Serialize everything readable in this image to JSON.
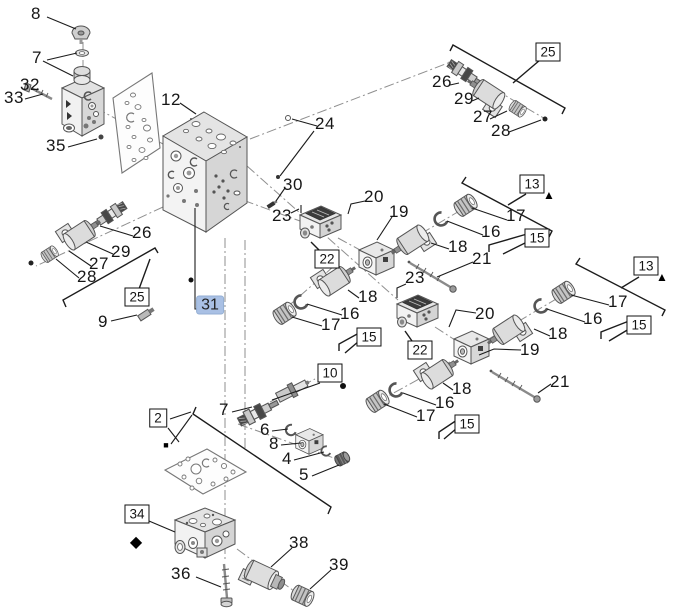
{
  "diagram": {
    "type": "exploded-parts-diagram",
    "background_color": "#ffffff",
    "line_color": "#1c1c1c",
    "highlighted_item": "31",
    "highlight_bg_color": "#a9c0e4",
    "callouts": [
      {
        "text": "8",
        "kind": "plain",
        "x": 36,
        "y": 14
      },
      {
        "text": "7",
        "kind": "plain",
        "x": 37,
        "y": 58
      },
      {
        "text": "32",
        "kind": "plain",
        "x": 30,
        "y": 85
      },
      {
        "text": "33",
        "kind": "plain",
        "x": 14,
        "y": 98
      },
      {
        "text": "35",
        "kind": "plain",
        "x": 56,
        "y": 146
      },
      {
        "text": "12",
        "kind": "plain",
        "x": 171,
        "y": 100
      },
      {
        "text": "24",
        "kind": "plain",
        "x": 325,
        "y": 124
      },
      {
        "text": "30",
        "kind": "plain",
        "x": 293,
        "y": 185
      },
      {
        "text": "23",
        "kind": "plain",
        "x": 282,
        "y": 216
      },
      {
        "text": "26",
        "kind": "plain",
        "x": 142,
        "y": 233
      },
      {
        "text": "29",
        "kind": "plain",
        "x": 121,
        "y": 252
      },
      {
        "text": "27",
        "kind": "plain",
        "x": 99,
        "y": 264
      },
      {
        "text": "28",
        "kind": "plain",
        "x": 87,
        "y": 277
      },
      {
        "text": "9",
        "kind": "plain",
        "x": 103,
        "y": 322
      },
      {
        "text": "26",
        "kind": "plain",
        "x": 442,
        "y": 82
      },
      {
        "text": "29",
        "kind": "plain",
        "x": 464,
        "y": 99
      },
      {
        "text": "27",
        "kind": "plain",
        "x": 483,
        "y": 117
      },
      {
        "text": "28",
        "kind": "plain",
        "x": 501,
        "y": 131
      },
      {
        "text": "20",
        "kind": "plain",
        "x": 374,
        "y": 197
      },
      {
        "text": "19",
        "kind": "plain",
        "x": 399,
        "y": 212
      },
      {
        "text": "18",
        "kind": "plain",
        "x": 368,
        "y": 297
      },
      {
        "text": "16",
        "kind": "plain",
        "x": 350,
        "y": 314
      },
      {
        "text": "17",
        "kind": "plain",
        "x": 331,
        "y": 325
      },
      {
        "text": "18",
        "kind": "plain",
        "x": 458,
        "y": 247
      },
      {
        "text": "21",
        "kind": "plain",
        "x": 482,
        "y": 259
      },
      {
        "text": "23",
        "kind": "plain",
        "x": 415,
        "y": 278
      },
      {
        "text": "17",
        "kind": "plain",
        "x": 516,
        "y": 216
      },
      {
        "text": "16",
        "kind": "plain",
        "x": 491,
        "y": 232
      },
      {
        "text": "20",
        "kind": "plain",
        "x": 485,
        "y": 314
      },
      {
        "text": "19",
        "kind": "plain",
        "x": 530,
        "y": 350
      },
      {
        "text": "18",
        "kind": "plain",
        "x": 558,
        "y": 334
      },
      {
        "text": "21",
        "kind": "plain",
        "x": 560,
        "y": 382
      },
      {
        "text": "17",
        "kind": "plain",
        "x": 618,
        "y": 302
      },
      {
        "text": "16",
        "kind": "plain",
        "x": 593,
        "y": 319
      },
      {
        "text": "18",
        "kind": "plain",
        "x": 462,
        "y": 389
      },
      {
        "text": "16",
        "kind": "plain",
        "x": 445,
        "y": 403
      },
      {
        "text": "17",
        "kind": "plain",
        "x": 426,
        "y": 416
      },
      {
        "text": "7",
        "kind": "plain",
        "x": 224,
        "y": 410
      },
      {
        "text": "6",
        "kind": "plain",
        "x": 265,
        "y": 430
      },
      {
        "text": "8",
        "kind": "plain",
        "x": 274,
        "y": 444
      },
      {
        "text": "4",
        "kind": "plain",
        "x": 287,
        "y": 459
      },
      {
        "text": "5",
        "kind": "plain",
        "x": 304,
        "y": 475
      },
      {
        "text": "36",
        "kind": "plain",
        "x": 181,
        "y": 574
      },
      {
        "text": "38",
        "kind": "plain",
        "x": 299,
        "y": 543
      },
      {
        "text": "39",
        "kind": "plain",
        "x": 339,
        "y": 565
      },
      {
        "text": "25",
        "kind": "boxed",
        "x": 137,
        "y": 297
      },
      {
        "text": "25",
        "kind": "boxed",
        "x": 548,
        "y": 52
      },
      {
        "text": "22",
        "kind": "boxed",
        "x": 327,
        "y": 259
      },
      {
        "text": "22",
        "kind": "boxed",
        "x": 420,
        "y": 350
      },
      {
        "text": "15",
        "kind": "boxed",
        "x": 369,
        "y": 337
      },
      {
        "text": "15",
        "kind": "boxed",
        "x": 537,
        "y": 238
      },
      {
        "text": "15",
        "kind": "boxed",
        "x": 639,
        "y": 325
      },
      {
        "text": "15",
        "kind": "boxed",
        "x": 467,
        "y": 424
      },
      {
        "text": "13",
        "kind": "boxed",
        "x": 532,
        "y": 184
      },
      {
        "text": "13",
        "kind": "boxed",
        "x": 646,
        "y": 266
      },
      {
        "text": "10",
        "kind": "boxed",
        "x": 330,
        "y": 373
      },
      {
        "text": "2",
        "kind": "boxed",
        "x": 158,
        "y": 418
      },
      {
        "text": "34",
        "kind": "boxed",
        "x": 137,
        "y": 514
      },
      {
        "text": "31",
        "kind": "highlight",
        "x": 210,
        "y": 305
      },
      {
        "text": "▲",
        "kind": "tri",
        "icon": "triangle-marker",
        "x": 549,
        "y": 195
      },
      {
        "text": "▲",
        "kind": "tri",
        "icon": "triangle-marker",
        "x": 662,
        "y": 277
      },
      {
        "text": "◆",
        "kind": "diamond",
        "icon": "diamond-marker",
        "x": 136,
        "y": 542
      },
      {
        "text": "■",
        "kind": "square",
        "icon": "square-marker",
        "x": 166,
        "y": 445
      }
    ]
  }
}
